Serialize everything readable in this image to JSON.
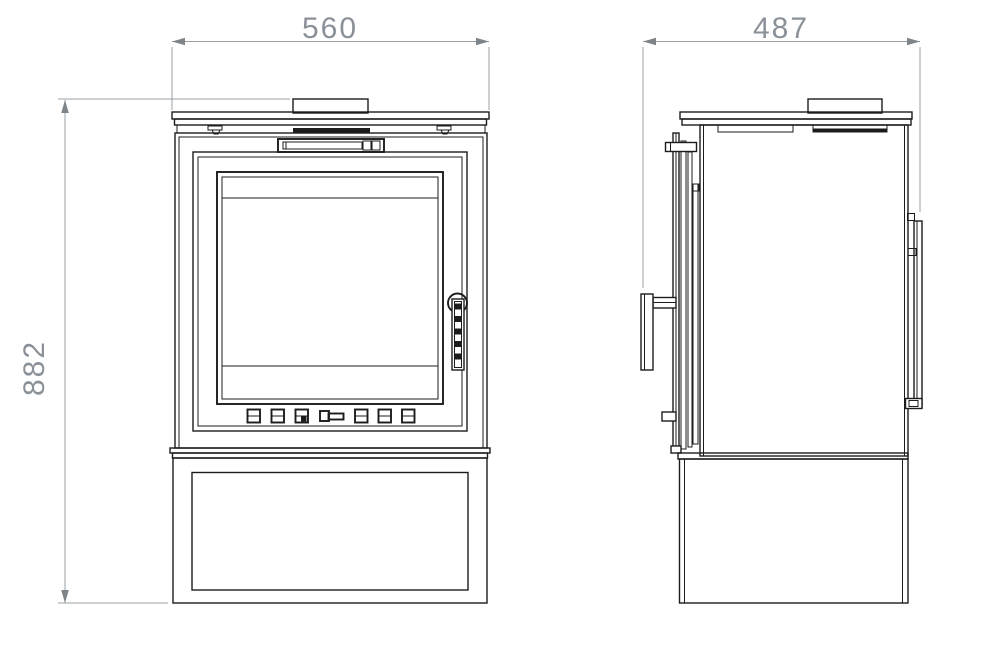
{
  "dimensions": {
    "width_front": "560",
    "depth_side": "487",
    "height": "882"
  },
  "colors": {
    "drawing_line": "#1c1c1c",
    "dimension_line": "#9aa0a4",
    "dimension_arrow": "#7e858a",
    "dimension_text": "#8a9198",
    "background": "#ffffff"
  }
}
